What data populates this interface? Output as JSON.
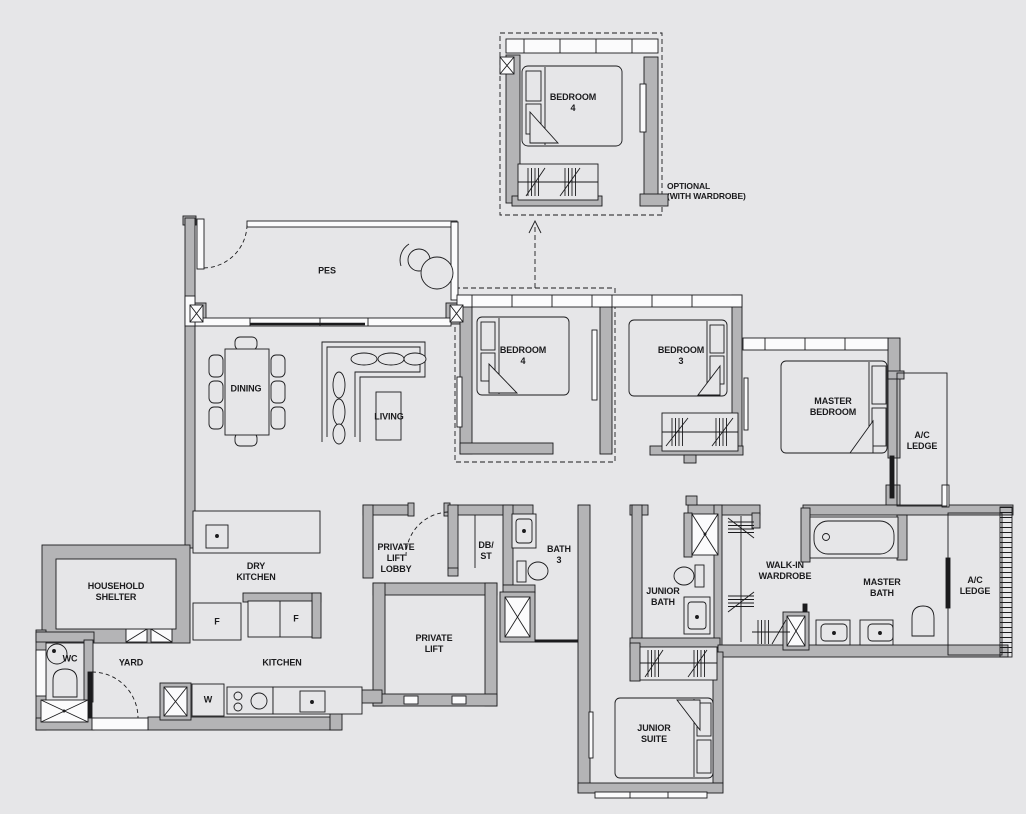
{
  "plan_title": "4-bedroom unit floor plan",
  "colors": {
    "background": "#e6e6e8",
    "wall": "#b4b4b6",
    "line": "#1b1b1d",
    "window": "#fbfbfc"
  },
  "optional_room": {
    "label": "BEDROOM\n4",
    "note": "OPTIONAL\n(WITH WARDROBE)"
  },
  "rooms": {
    "pes": "PES",
    "dining": "DINING",
    "living": "LIVING",
    "bedroom4": "BEDROOM\n4",
    "bedroom3": "BEDROOM\n3",
    "master_bedroom": "MASTER\nBEDROOM",
    "ac_ledge_upper": "A/C\nLEDGE",
    "household_shelter": "HOUSEHOLD\nSHELTER",
    "dry_kitchen": "DRY\nKITCHEN",
    "private_lift_lobby": "PRIVATE\nLIFT\nLOBBY",
    "db_st": "DB/\nST",
    "bath3": "BATH\n3",
    "junior_bath": "JUNIOR\nBATH",
    "walk_in_wardrobe": "WALK-IN\nWARDROBE",
    "master_bath": "MASTER\nBATH",
    "ac_ledge_lower": "A/C\nLEDGE",
    "wc": "WC",
    "yard": "YARD",
    "kitchen": "KITCHEN",
    "private_lift": "PRIVATE\nLIFT",
    "junior_suite": "JUNIOR\nSUITE"
  },
  "appliances": {
    "fridge1": "F",
    "fridge2": "F",
    "washer": "W"
  }
}
